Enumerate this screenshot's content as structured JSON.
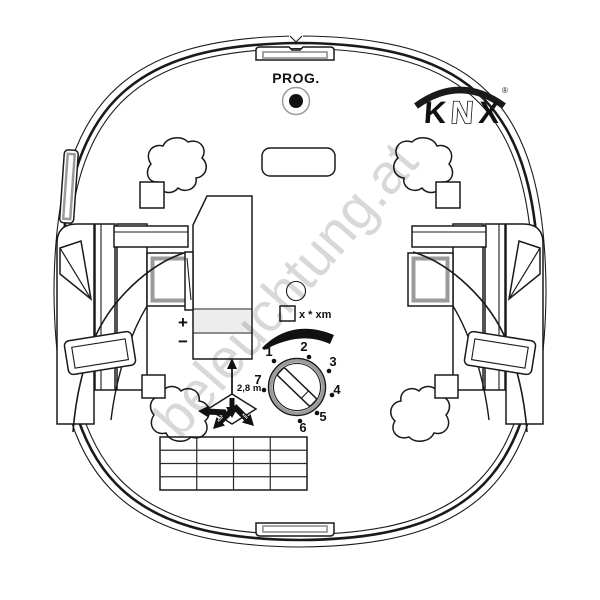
{
  "watermark": {
    "text": "beleuchtung.at",
    "color": "#d4d4d4"
  },
  "device": {
    "prog": {
      "label": "PROG."
    },
    "knx": {
      "k": "K",
      "n": "N",
      "x": "X",
      "registered": "®"
    },
    "terminal": {
      "plus": "+",
      "minus": "−"
    },
    "mode_label": "x * xm",
    "height_label": "2,8 m",
    "arrow_mark": "xm",
    "dial": {
      "numbers": [
        {
          "label": "1",
          "tx": 269,
          "ty": 356,
          "dx": 274,
          "dy": 361
        },
        {
          "label": "2",
          "tx": 304,
          "ty": 351,
          "dx": 309,
          "dy": 357
        },
        {
          "label": "3",
          "tx": 333,
          "ty": 366,
          "dx": 329,
          "dy": 371
        },
        {
          "label": "4",
          "tx": 337,
          "ty": 394,
          "dx": 332,
          "dy": 395
        },
        {
          "label": "5",
          "tx": 323,
          "ty": 421,
          "dx": 317,
          "dy": 413
        },
        {
          "label": "6",
          "tx": 303,
          "ty": 432,
          "dx": 300,
          "dy": 421
        },
        {
          "label": "7",
          "tx": 258,
          "ty": 384,
          "dx": 264,
          "dy": 390
        }
      ]
    },
    "table": {
      "rows": 4,
      "cols": 4
    }
  },
  "colors": {
    "line": "#1a1a1a",
    "gray": "#9b9b9b",
    "light_fill": "#ededed",
    "watermark": "#d4d4d4"
  }
}
